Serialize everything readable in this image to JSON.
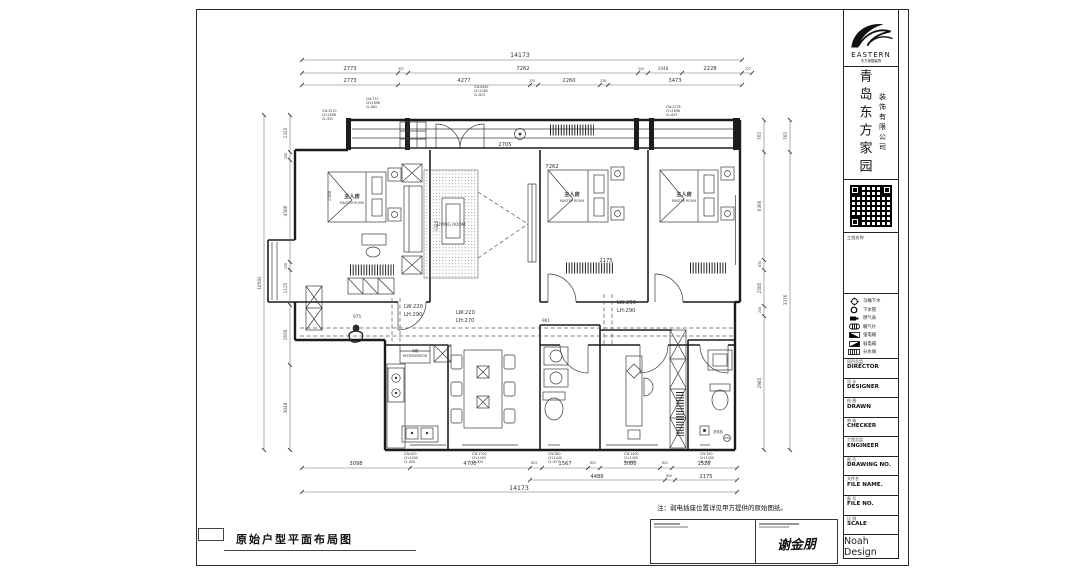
{
  "sheet": {
    "plan_title": "原始户型平面布局图",
    "note": "注：弱电插座位置详见甲方提供的原始图纸。",
    "signature": "谢金朋"
  },
  "title_block": {
    "logo_text": "EASTERN",
    "logo_sub": "东方家园装饰",
    "company_main": "青岛东方家园",
    "company_sub": "装饰有限公司",
    "project_label": "工程名称",
    "legend": [
      {
        "icon": "toilet-drain-icon",
        "label": "马桶下水"
      },
      {
        "icon": "drain-pipe-icon",
        "label": "下水管"
      },
      {
        "icon": "gas-meter-icon",
        "label": "燃气表"
      },
      {
        "icon": "radiator-icon",
        "label": "暖气片"
      },
      {
        "icon": "power-box-icon",
        "label": "强电箱"
      },
      {
        "icon": "lowvolt-box-icon",
        "label": "弱电箱"
      },
      {
        "icon": "manifold-icon",
        "label": "分水阀"
      }
    ],
    "fields": [
      {
        "cn": "项目总监",
        "en": "DIRECTOR"
      },
      {
        "cn": "设 计",
        "en": "DESIGNER"
      },
      {
        "cn": "绘 图",
        "en": "DRAWN"
      },
      {
        "cn": "审 核",
        "en": "CHECKER"
      },
      {
        "cn": "工程总监",
        "en": "ENGINEER"
      },
      {
        "cn": "图 号",
        "en": "DRAWING NO."
      },
      {
        "cn": "文件名",
        "en": "FILE NAME."
      },
      {
        "cn": "备 号",
        "en": "FILE NO."
      },
      {
        "cn": "比 例",
        "en": "SCALE"
      }
    ],
    "brand": "Noah Design"
  },
  "rooms": {
    "bedroom_cn": "主人房",
    "bedroom_en": "MASTER ROOM",
    "living_en": "LIVING ROOM",
    "fridge_cn": "冰箱",
    "fridge_en": "REFRIGERATOR",
    "washer": "洗衣机"
  },
  "beams": [
    [
      "LW:220",
      "LH:290"
    ],
    [
      "LW:220",
      "LH:270"
    ],
    [
      "LW:200",
      "LH:290"
    ]
  ],
  "dims": {
    "top1": [
      "14173"
    ],
    "top2": [
      "2773",
      "327",
      "7262",
      "225",
      "1048",
      "2228",
      "227"
    ],
    "top3": [
      "2773",
      "4277",
      "225",
      "2260",
      "228",
      "3473"
    ],
    "bot1": [
      "3098",
      "4700",
      "623",
      "1567",
      "625",
      "3080",
      "622",
      "1526"
    ],
    "bot2": [
      "4488",
      "600",
      "2175"
    ],
    "bot3": [
      "14173"
    ],
    "left": [
      "1325",
      "230",
      "4506",
      "230",
      "1125",
      "1650",
      "3048"
    ],
    "left_outer": [
      "10592"
    ],
    "right": [
      "765",
      "6366",
      "630",
      "2505",
      "230",
      "2985"
    ],
    "right_outer": [
      "765",
      "3376"
    ],
    "inner": {
      "a": "7262",
      "b": "2705",
      "c": "2175",
      "d": "975",
      "e": "961",
      "f": "1325",
      "g": "1500"
    }
  },
  "windows": {
    "top": [
      "CW-6462",
      "CH-1065",
      "CL-623"
    ],
    "left_upper": [
      "CW-775",
      "CH-1698",
      "CL-682"
    ],
    "left_lower": [
      "CW-2570",
      "CH-1698",
      "CL-925"
    ],
    "right_upper": [
      "CW-2278",
      "CH-1698",
      "CL-623"
    ],
    "bottom": [
      [
        "CW-900",
        "CH-1400",
        "CL-900"
      ],
      [
        "CW-1700",
        "CH-1400",
        "CL-920"
      ],
      [
        "CW-580",
        "CH-1440",
        "CL-927"
      ],
      [
        "CW-1400",
        "CH-1400",
        "CL-915"
      ],
      [
        "CW-390",
        "CH-1400",
        "CL-922"
      ]
    ]
  }
}
